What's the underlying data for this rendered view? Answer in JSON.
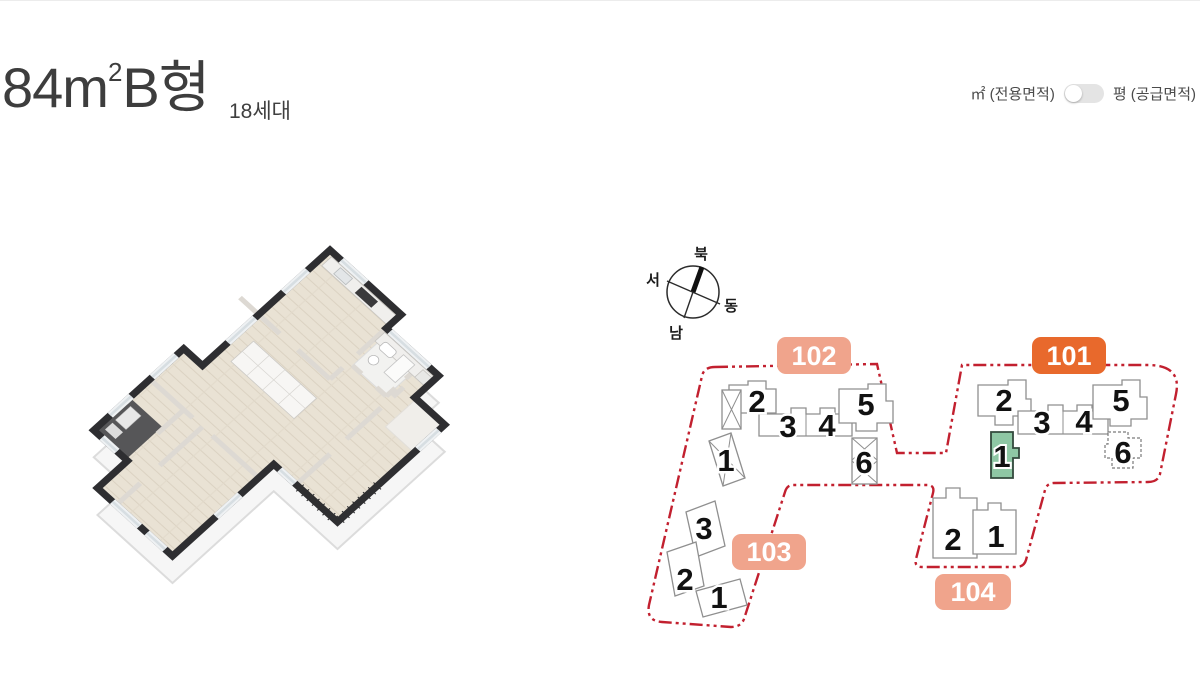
{
  "header": {
    "title_base": "84m",
    "title_sup": "2",
    "title_suffix": "B형",
    "household_count": "18세대"
  },
  "area_toggle": {
    "m2_label": "㎡ (전용면적)",
    "pyeong_label": "평 (공급면적)"
  },
  "compass": {
    "north": "북",
    "west": "서",
    "east": "동",
    "south": "남"
  },
  "site_plan": {
    "boundary_color": "#c2202f",
    "badge_color": "#f0a48c",
    "badge_active_color": "#e8692c",
    "selected_unit_color": "#8ec7a4",
    "b101": {
      "label": "101",
      "u1": "1",
      "u2": "2",
      "u3": "3",
      "u4": "4",
      "u5": "5",
      "u6": "6"
    },
    "b102": {
      "label": "102",
      "u1": "1",
      "u2": "2",
      "u3": "3",
      "u4": "4",
      "u5": "5",
      "u6": "6"
    },
    "b103": {
      "label": "103",
      "u1": "1",
      "u2": "2",
      "u3": "3"
    },
    "b104": {
      "label": "104",
      "u1": "1",
      "u2": "2"
    }
  }
}
